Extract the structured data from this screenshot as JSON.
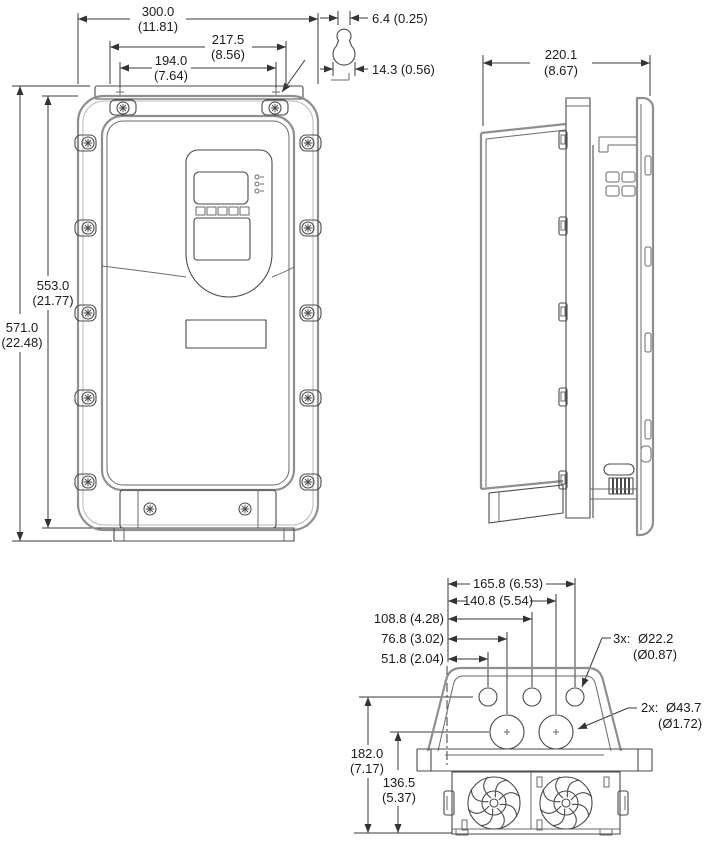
{
  "drawing": {
    "kind": "dimension-drawing",
    "views": {
      "front": "front-view",
      "side": "side-view",
      "bottom": "bottom-view"
    },
    "dims": {
      "front": {
        "width": {
          "mm": "300.0",
          "in": "(11.81)"
        },
        "slot_outer": {
          "mm": "217.5",
          "in": "(8.56)"
        },
        "slot_inner": {
          "mm": "194.0",
          "in": "(7.64)"
        },
        "height_flange": {
          "mm": "553.0",
          "in": "(21.77)"
        },
        "height_overall": {
          "mm": "571.0",
          "in": "(22.48)"
        },
        "keyhole_width": "6.4 (0.25)",
        "keyhole_dia": "14.3 (0.56)"
      },
      "side": {
        "depth": {
          "mm": "220.1",
          "in": "(8.67)"
        }
      },
      "bottom": {
        "pos1": "51.8 (2.04)",
        "pos2": "76.8 (3.02)",
        "pos3": "108.8 (4.28)",
        "pos4": "140.8 (5.54)",
        "pos5": "165.8 (6.53)",
        "height1": {
          "mm": "182.0",
          "in": "(7.17)"
        },
        "height2": {
          "mm": "136.5",
          "in": "(5.37)"
        },
        "small_holes": {
          "count": "3x:",
          "dia": "Ø22.2",
          "dia_in": "(Ø0.87)"
        },
        "large_holes": {
          "count": "2x:",
          "dia": "Ø43.7",
          "dia_in": "(Ø1.72)"
        }
      }
    }
  }
}
